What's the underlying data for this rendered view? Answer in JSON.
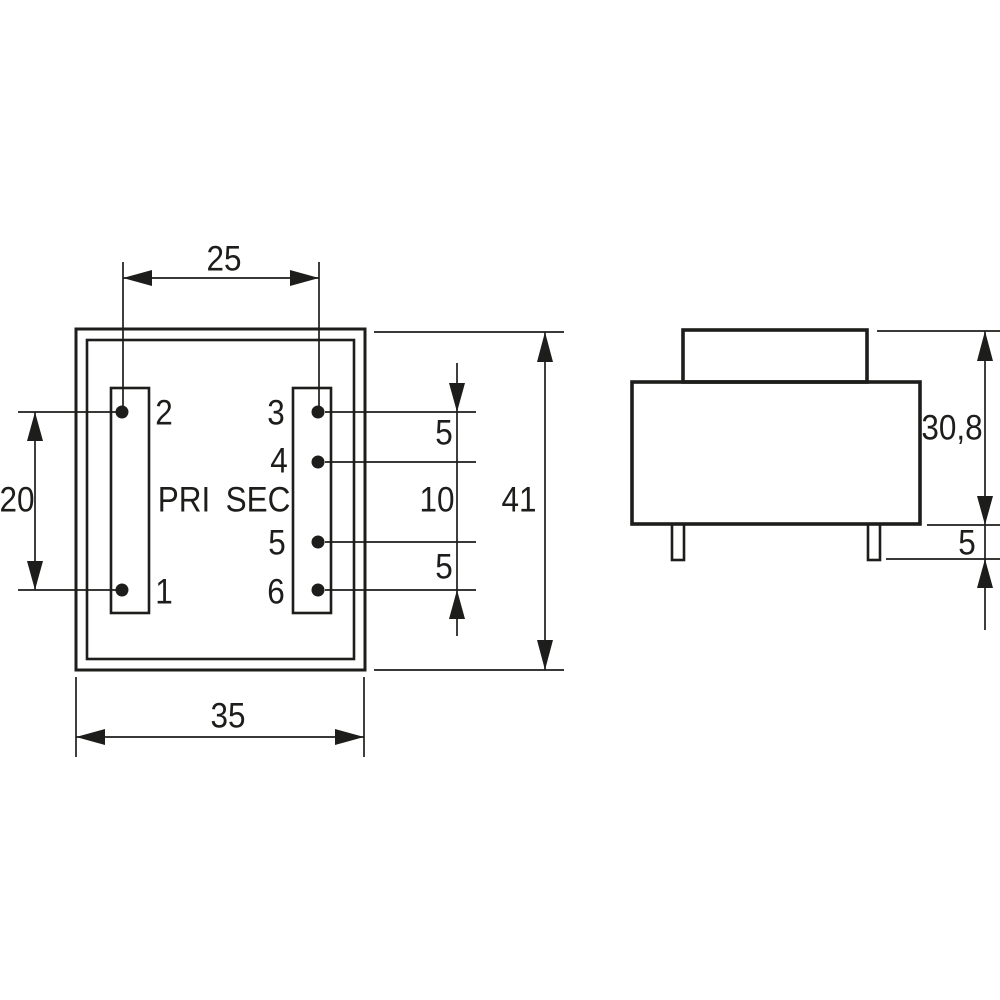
{
  "drawing": {
    "type": "technical-dimension-drawing",
    "subject": "PCB-mount transformer: top view (pinout) and side view",
    "colors": {
      "ink": "#1d1d1b",
      "background": "#ffffff"
    },
    "top_view": {
      "pri_label": "PRI",
      "sec_label": "SEC",
      "pin_labels": {
        "pin1": "1",
        "pin2": "2",
        "pin3": "3",
        "pin4": "4",
        "pin5": "5",
        "pin6": "6"
      },
      "dimensions": {
        "pin_row_spacing": "25",
        "pri_pin_pitch": "20",
        "body_width": "35",
        "body_length": "41",
        "sec_pitch_pin3_pin4": "5",
        "sec_pitch_pin4_pin5": "10",
        "sec_pitch_pin5_pin6": "5"
      }
    },
    "side_view": {
      "dimensions": {
        "body_height": "30,8",
        "pin_length": "5"
      }
    }
  }
}
